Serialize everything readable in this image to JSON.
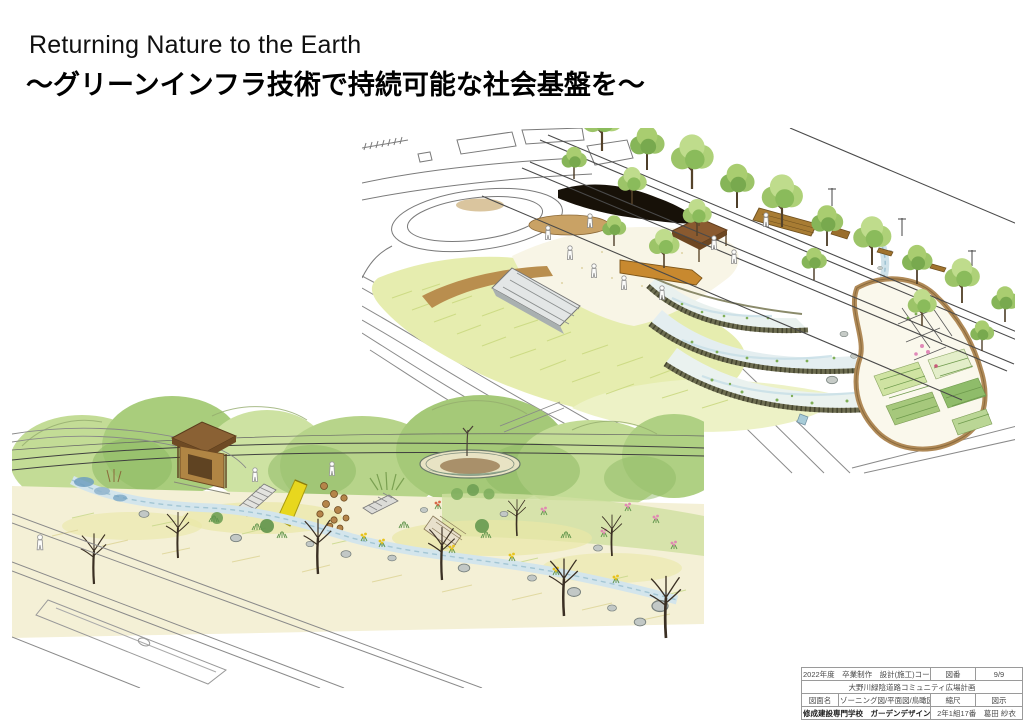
{
  "slide": {
    "title_en": "Returning Nature to the Earth",
    "title_ja": "～グリーンインフラ技術で持続可能な社会基盤を～",
    "background": "#ffffff"
  },
  "illustrations": {
    "birdseye": {
      "description": "hand-drawn aerial perspective: terraced rain gardens, gazebo, street trees, allotment garden, oval plaza"
    },
    "eyelevel": {
      "description": "hand-drawn street-level perspective: pavilion, slide, circular pond, stream, rocks and flowering planting"
    },
    "palette": {
      "foliage": "#9cc468",
      "lawn": "#e6edaf",
      "path_brown": "#b98e4e",
      "roof_brown": "#8a5a30",
      "water": "#cfe2ea",
      "slide_yellow": "#e8d71e",
      "ink": "#4a4a4a"
    }
  },
  "title_block": {
    "r1c1": "2022年度　卒業制作　設計(施工)コース",
    "r1c2": "図番",
    "r1c3": "9/9",
    "r2c1": "大野川緑陰道路コミュニティ広場計画",
    "r3c1": "図面名",
    "r3c2": "ゾーニング図/平面図/鳥瞰図",
    "r3c3": "縮尺",
    "r3c4": "図示",
    "r4c1": "修成建設専門学校　ガーデンデザイン学科",
    "r4c2": "2年1組17番　葛田 紗衣"
  }
}
